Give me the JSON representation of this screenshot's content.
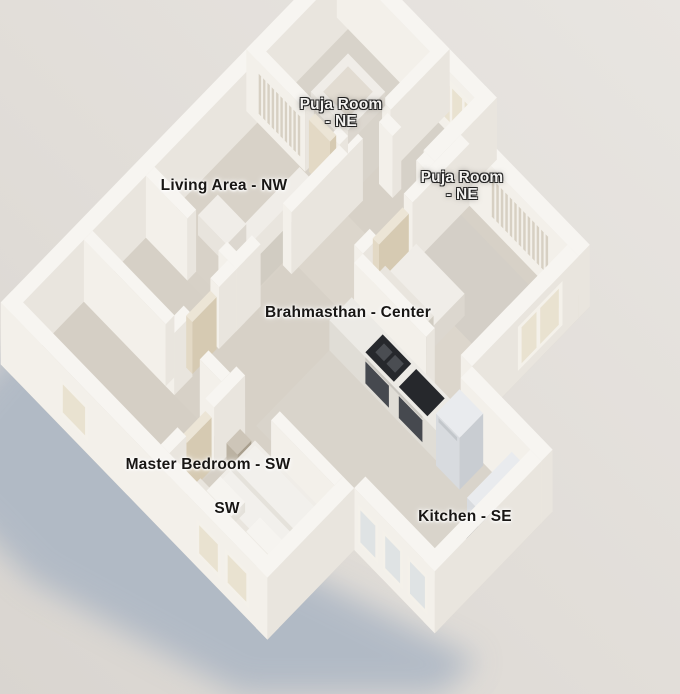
{
  "labels": {
    "puja_room_top": {
      "line1": "Puja Room",
      "line2": "- NE"
    },
    "living_area": "Living Area - NW",
    "puja_room_right": {
      "line1": "Puja Room",
      "line2": "- NE"
    },
    "brahmasthan": "Brahmasthan - Center",
    "master_bedroom": "Master Bedroom - SW",
    "sw_marker": "SW",
    "kitchen": "Kitchen - SE"
  },
  "colors": {
    "background_light": "#e8e5e1",
    "background_dark": "#d9d5d0",
    "shadow": "#a7b3c2",
    "floor": "#d7d1c7",
    "floor_center": "#dcd6cc",
    "wall_top": "#f7f5f1",
    "wall_south": "#f3f0ea",
    "wall_east": "#e9e5de",
    "frame": "#f4f1ea",
    "glass_warm": "#e9e2d0",
    "glass_cool": "#dfe3e4",
    "louver": "#d7d0c3",
    "stove_dark": "#26282c",
    "steel": "#d8dbdf",
    "label_dark": "#181614",
    "label_light": "#f4f3f1"
  }
}
